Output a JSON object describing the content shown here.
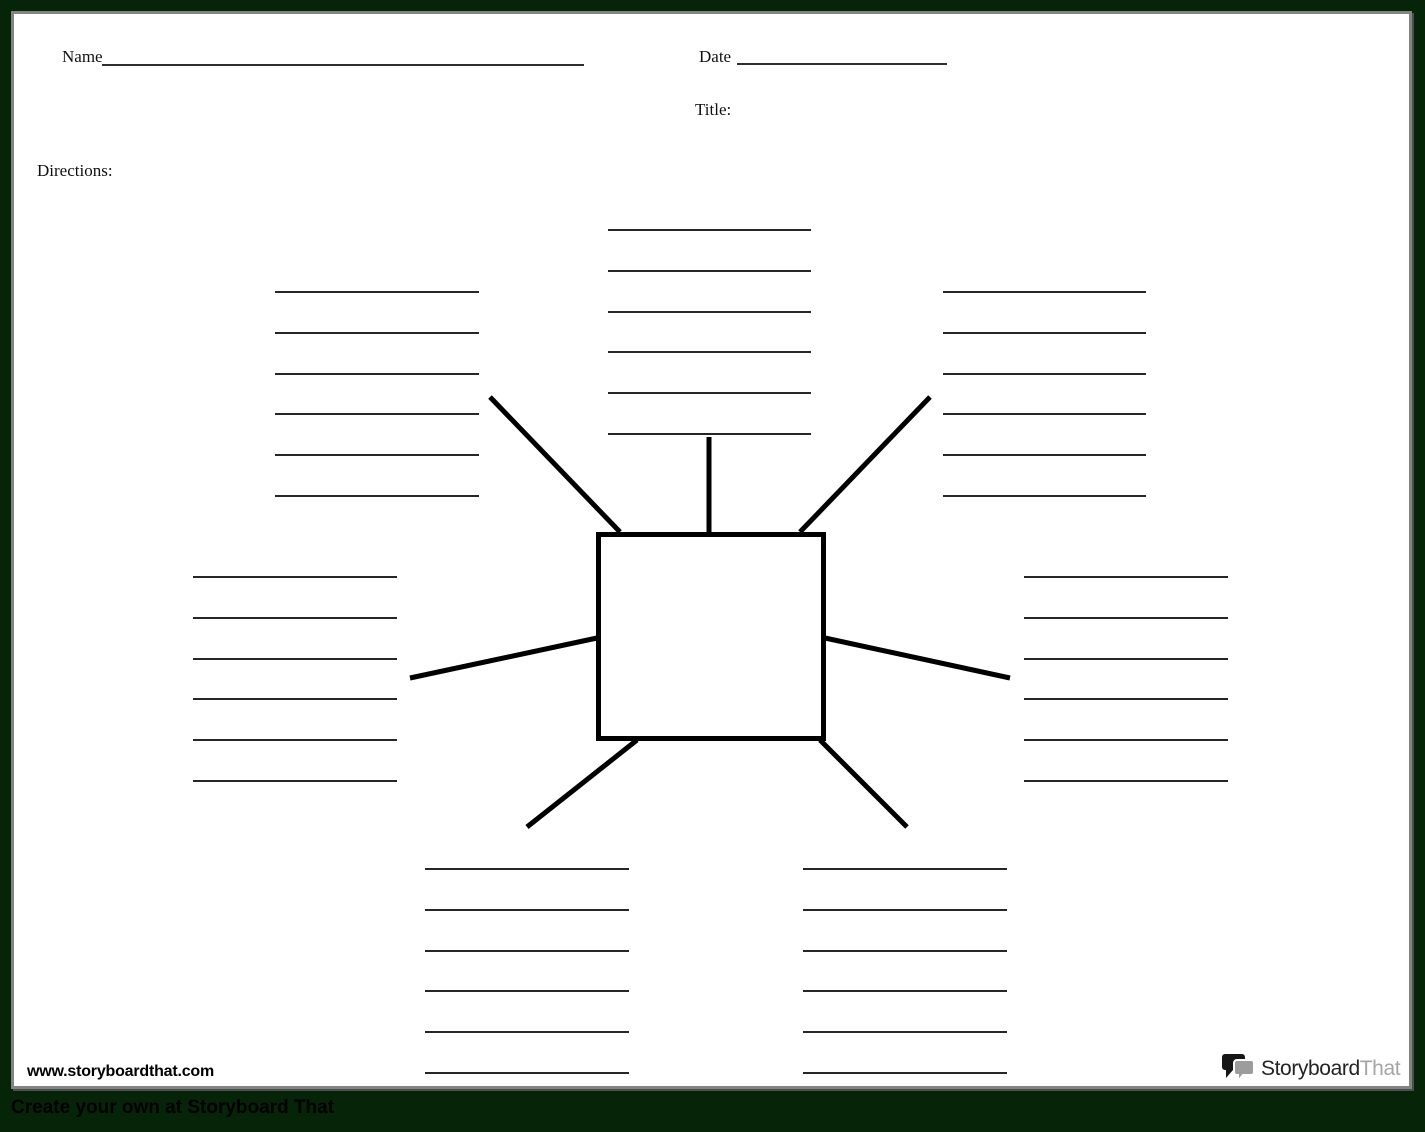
{
  "header": {
    "name_label": "Name",
    "date_label": "Date",
    "title_label": "Title:",
    "directions_label": "Directions:"
  },
  "diagram": {
    "type": "spider-map",
    "center_shape": "rectangle",
    "center_text": "",
    "spoke_count": 7,
    "clusters": [
      {
        "position": "top-left",
        "blank_lines": 6
      },
      {
        "position": "top-center",
        "blank_lines": 6
      },
      {
        "position": "top-right",
        "blank_lines": 6
      },
      {
        "position": "middle-left",
        "blank_lines": 6
      },
      {
        "position": "middle-right",
        "blank_lines": 6
      },
      {
        "position": "bottom-left",
        "blank_lines": 6
      },
      {
        "position": "bottom-right",
        "blank_lines": 6
      }
    ]
  },
  "footer": {
    "website": "www.storyboardthat.com",
    "logo_part1": "Storyboard",
    "logo_part2": "That",
    "tagline": "Create your own at Storyboard That"
  },
  "colors": {
    "frame_green": "#062408",
    "page_white": "#ffffff",
    "ink_black": "#000000",
    "blank_line_gray": "#262626",
    "page_border_gray": "#848484",
    "logo_gray": "#a5a5a5"
  }
}
